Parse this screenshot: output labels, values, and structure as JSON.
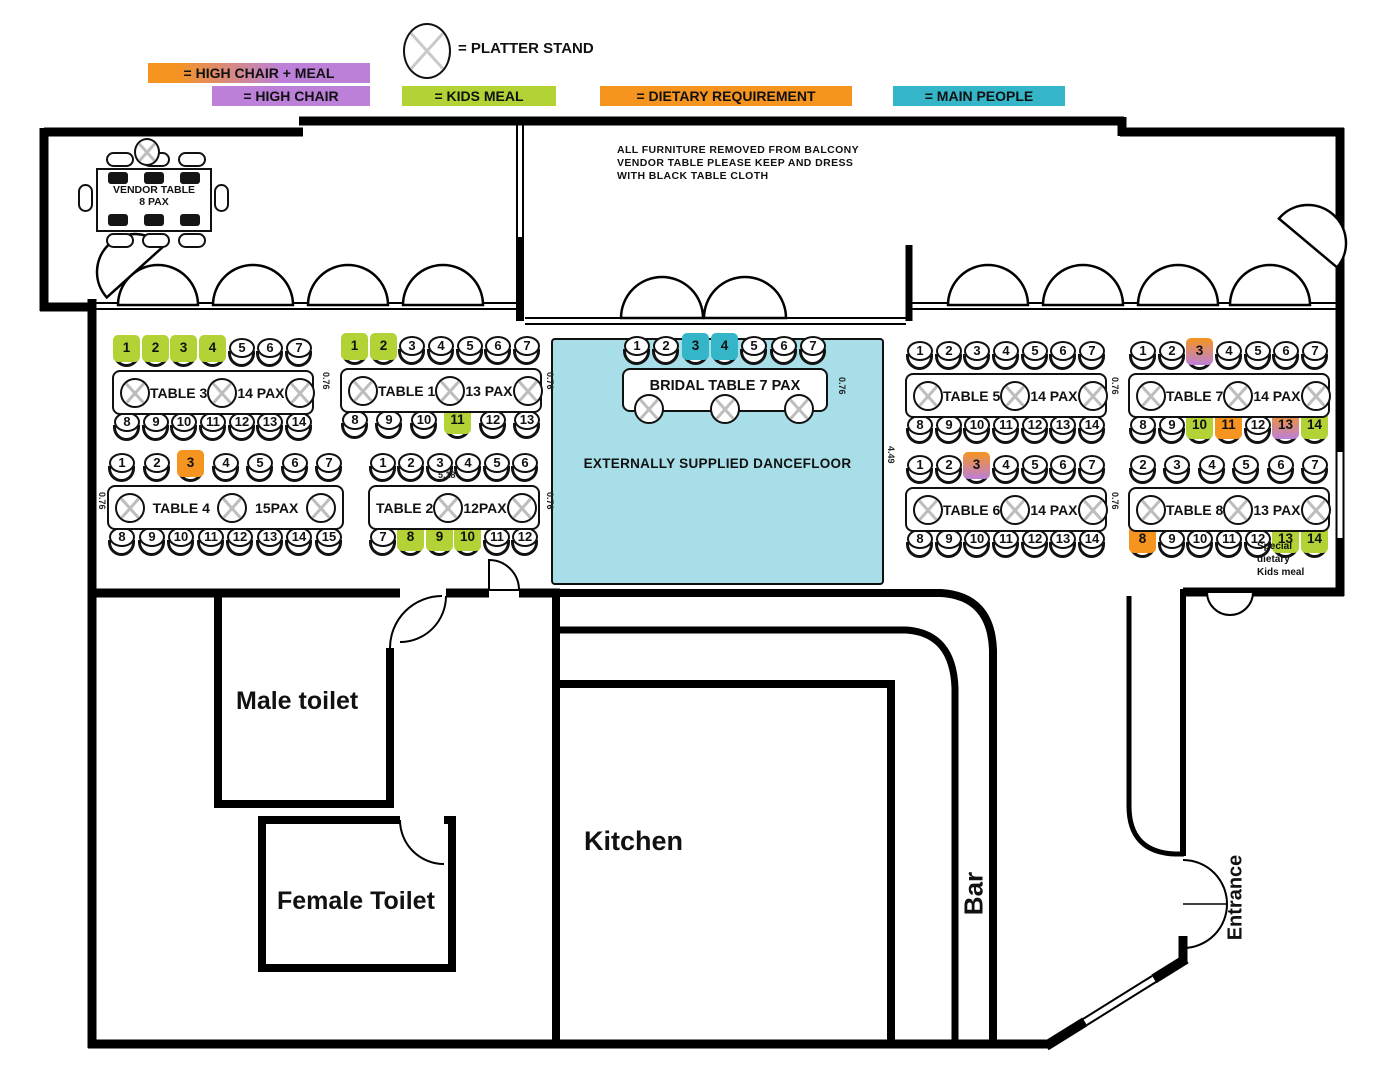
{
  "legend": {
    "platter_label": "= PLATTER STAND",
    "items": [
      {
        "id": "high_chair_meal",
        "label": "= HIGH CHAIR + MEAL",
        "swatch": "gradient",
        "from": "#f5941f",
        "to": "#bc80d9"
      },
      {
        "id": "high_chair",
        "label": "= HIGH CHAIR",
        "color": "#bc80d9"
      },
      {
        "id": "kids_meal",
        "label": "= KIDS MEAL",
        "color": "#b2d235"
      },
      {
        "id": "dietary",
        "label": "= DIETARY REQUIREMENT",
        "color": "#f5941f"
      },
      {
        "id": "main_people",
        "label": "= MAIN PEOPLE",
        "color": "#35b5c8"
      }
    ]
  },
  "mark_colors": {
    "kids_meal": "#b2d235",
    "dietary": "#f5941f",
    "high_chair": "#bc80d9",
    "main_people": "#35b5c8",
    "high_chair_meal": {
      "from": "#f5941f",
      "to": "#bc80d9"
    }
  },
  "balcony_note": [
    "ALL FURNITURE REMOVED FROM BALCONY",
    "VENDOR TABLE PLEASE KEEP AND DRESS",
    "WITH BLACK TABLE CLOTH"
  ],
  "vendor_table": {
    "line1": "VENDOR TABLE",
    "line2": "8 PAX"
  },
  "dancefloor": {
    "label": "EXTERNALLY SUPPLIED DANCEFLOOR",
    "color": "#a8dee8"
  },
  "rooms": {
    "male_toilet": "Male toilet",
    "female_toilet": "Female Toilet",
    "kitchen": "Kitchen",
    "bar": "Bar",
    "entrance": "Entrance"
  },
  "dimensions": {
    "seat_gap": "0.76",
    "dance": "4.49",
    "span": "5.18"
  },
  "special_note": [
    "Special",
    "dietary",
    "Kids meal"
  ],
  "tables": [
    {
      "id": "table3",
      "name": "TABLE 3",
      "pax": "14 PAX",
      "platters": 3,
      "top": [
        {
          "n": "1",
          "mark": "kids_meal"
        },
        {
          "n": "2",
          "mark": "kids_meal"
        },
        {
          "n": "3",
          "mark": "kids_meal"
        },
        {
          "n": "4",
          "mark": "kids_meal"
        },
        {
          "n": "5"
        },
        {
          "n": "6"
        },
        {
          "n": "7"
        }
      ],
      "bottom": [
        {
          "n": "8"
        },
        {
          "n": "9"
        },
        {
          "n": "10"
        },
        {
          "n": "11"
        },
        {
          "n": "12"
        },
        {
          "n": "13"
        },
        {
          "n": "14"
        }
      ]
    },
    {
      "id": "table1",
      "name": "TABLE 1",
      "pax": "13 PAX",
      "platters": 3,
      "top": [
        {
          "n": "1",
          "mark": "kids_meal"
        },
        {
          "n": "2",
          "mark": "kids_meal"
        },
        {
          "n": "3"
        },
        {
          "n": "4"
        },
        {
          "n": "5"
        },
        {
          "n": "6"
        },
        {
          "n": "7"
        }
      ],
      "bottom": [
        {
          "n": "8"
        },
        {
          "n": "9"
        },
        {
          "n": "10"
        },
        {
          "n": "11",
          "mark": "kids_meal"
        },
        {
          "n": "12"
        },
        {
          "n": "13"
        }
      ]
    },
    {
      "id": "bridal",
      "name": "BRIDAL TABLE 7 PAX",
      "pax": "",
      "platters": 3,
      "top": [
        {
          "n": "1"
        },
        {
          "n": "2"
        },
        {
          "n": "3",
          "mark": "main_people"
        },
        {
          "n": "4",
          "mark": "main_people"
        },
        {
          "n": "5"
        },
        {
          "n": "6"
        },
        {
          "n": "7"
        }
      ],
      "bottom": []
    },
    {
      "id": "table5",
      "name": "TABLE 5",
      "pax": "14 PAX",
      "platters": 3,
      "top": [
        {
          "n": "1"
        },
        {
          "n": "2"
        },
        {
          "n": "3"
        },
        {
          "n": "4"
        },
        {
          "n": "5"
        },
        {
          "n": "6"
        },
        {
          "n": "7"
        }
      ],
      "bottom": [
        {
          "n": "8"
        },
        {
          "n": "9"
        },
        {
          "n": "10"
        },
        {
          "n": "11"
        },
        {
          "n": "12"
        },
        {
          "n": "13"
        },
        {
          "n": "14"
        }
      ]
    },
    {
      "id": "table7",
      "name": "TABLE 7",
      "pax": "14 PAX",
      "platters": 3,
      "top": [
        {
          "n": "1"
        },
        {
          "n": "2"
        },
        {
          "n": "3",
          "mark": "high_chair_meal"
        },
        {
          "n": "4"
        },
        {
          "n": "5"
        },
        {
          "n": "6"
        },
        {
          "n": "7"
        }
      ],
      "bottom": [
        {
          "n": "8"
        },
        {
          "n": "9"
        },
        {
          "n": "10",
          "mark": "kids_meal"
        },
        {
          "n": "11",
          "mark": "dietary"
        },
        {
          "n": "12"
        },
        {
          "n": "13",
          "mark": "high_chair_meal"
        },
        {
          "n": "14",
          "mark": "kids_meal"
        }
      ]
    },
    {
      "id": "table4",
      "name": "TABLE 4",
      "pax": "15PAX",
      "platters": 3,
      "top": [
        {
          "n": "1"
        },
        {
          "n": "2"
        },
        {
          "n": "3",
          "mark": "dietary"
        },
        {
          "n": "4"
        },
        {
          "n": "5"
        },
        {
          "n": "6"
        },
        {
          "n": "7"
        }
      ],
      "bottom": [
        {
          "n": "8"
        },
        {
          "n": "9"
        },
        {
          "n": "10"
        },
        {
          "n": "11"
        },
        {
          "n": "12"
        },
        {
          "n": "13"
        },
        {
          "n": "14"
        },
        {
          "n": "15"
        }
      ]
    },
    {
      "id": "table2",
      "name": "TABLE 2",
      "pax": "12PAX",
      "platters": 2,
      "top": [
        {
          "n": "1"
        },
        {
          "n": "2"
        },
        {
          "n": "3"
        },
        {
          "n": "4"
        },
        {
          "n": "5"
        },
        {
          "n": "6"
        }
      ],
      "bottom": [
        {
          "n": "7"
        },
        {
          "n": "8",
          "mark": "kids_meal"
        },
        {
          "n": "9",
          "mark": "kids_meal"
        },
        {
          "n": "10",
          "mark": "kids_meal"
        },
        {
          "n": "11"
        },
        {
          "n": "12"
        }
      ]
    },
    {
      "id": "table6",
      "name": "TABLE 6",
      "pax": "14 PAX",
      "platters": 3,
      "top": [
        {
          "n": "1"
        },
        {
          "n": "2"
        },
        {
          "n": "3",
          "mark": "high_chair_meal"
        },
        {
          "n": "4"
        },
        {
          "n": "5"
        },
        {
          "n": "6"
        },
        {
          "n": "7"
        }
      ],
      "bottom": [
        {
          "n": "8"
        },
        {
          "n": "9"
        },
        {
          "n": "10"
        },
        {
          "n": "11"
        },
        {
          "n": "12"
        },
        {
          "n": "13"
        },
        {
          "n": "14"
        }
      ]
    },
    {
      "id": "table8",
      "name": "TABLE 8",
      "pax": "13 PAX",
      "platters": 3,
      "top": [
        {
          "n": "2"
        },
        {
          "n": "3"
        },
        {
          "n": "4"
        },
        {
          "n": "5"
        },
        {
          "n": "6"
        },
        {
          "n": "7"
        }
      ],
      "bottom": [
        {
          "n": "8",
          "mark": "dietary"
        },
        {
          "n": "9"
        },
        {
          "n": "10"
        },
        {
          "n": "11"
        },
        {
          "n": "12"
        },
        {
          "n": "13",
          "mark": "kids_meal"
        },
        {
          "n": "14",
          "mark": "kids_meal"
        }
      ]
    }
  ]
}
